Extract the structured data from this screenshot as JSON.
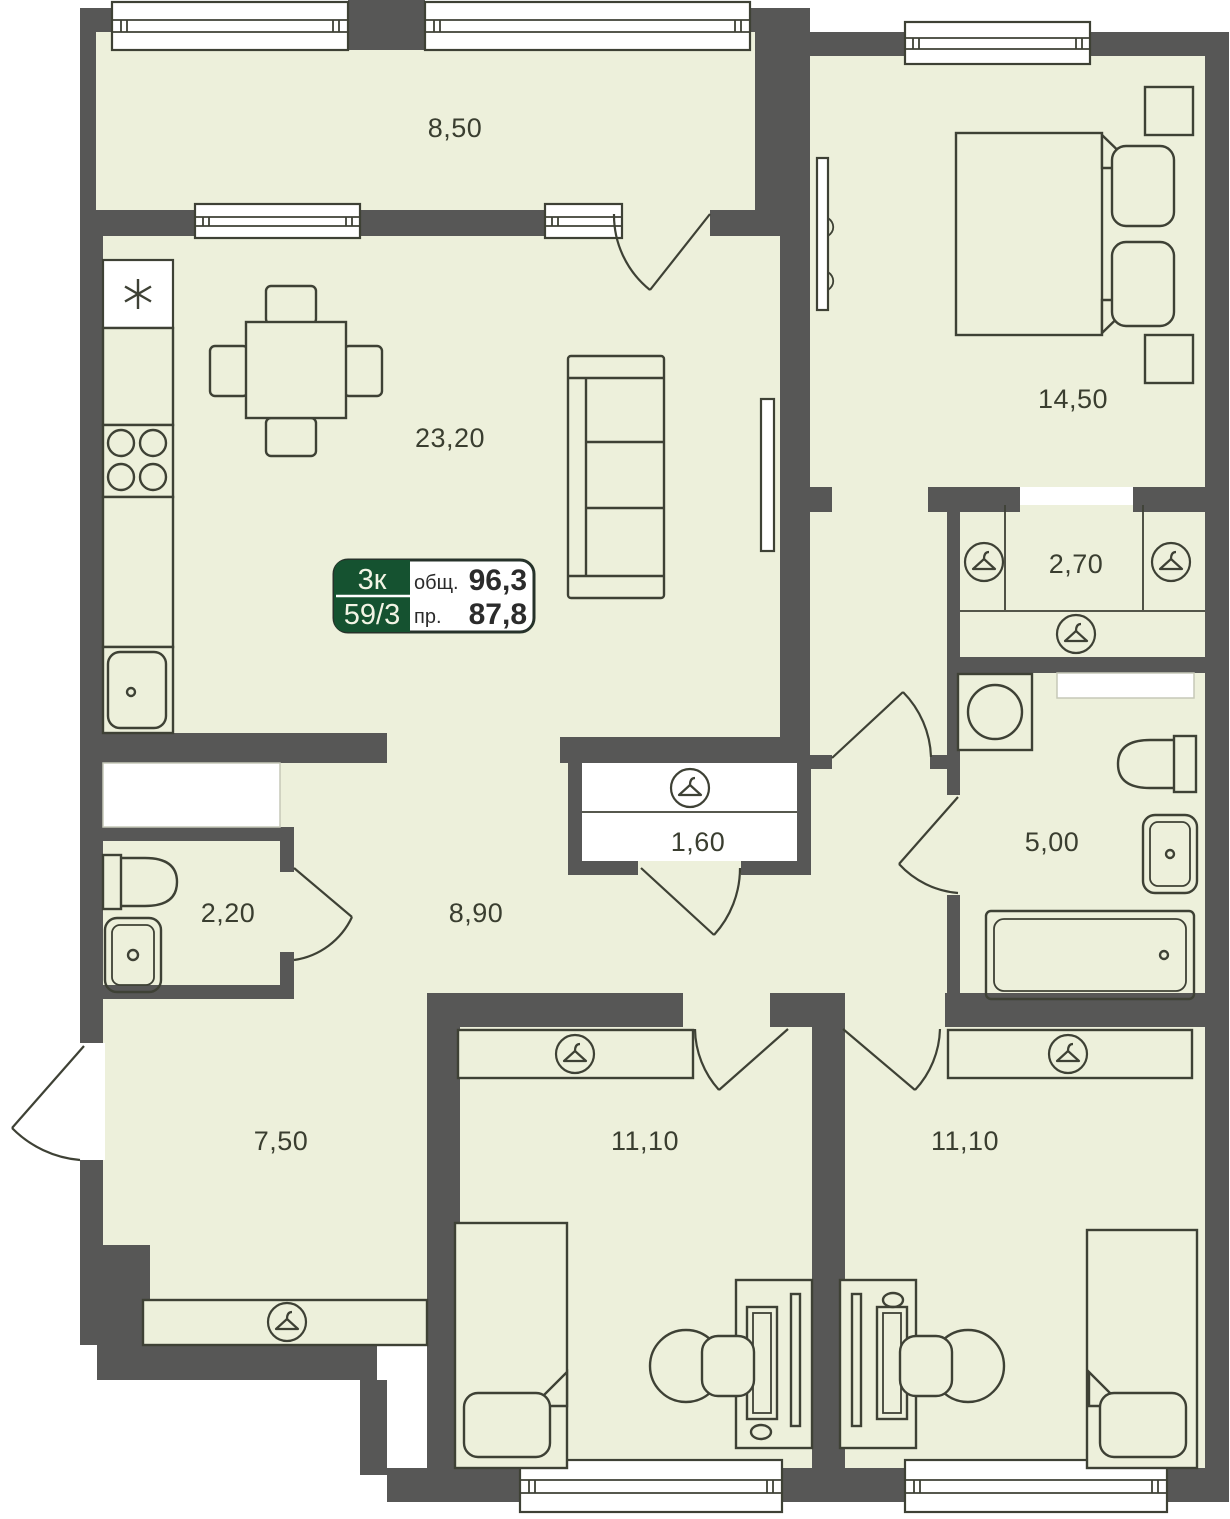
{
  "plan": {
    "unit_badge": {
      "rooms_label": "3к",
      "unit_number": "59/3",
      "total_label": "общ.",
      "total_value": "96,3",
      "living_label": "пр.",
      "living_value": "87,8"
    },
    "rooms": [
      {
        "name": "balcony",
        "area": "8,50"
      },
      {
        "name": "kitchen-living-room",
        "area": "23,20"
      },
      {
        "name": "master-bedroom",
        "area": "14,50"
      },
      {
        "name": "walk-in-wardrobe",
        "area": "2,70"
      },
      {
        "name": "hall-closet",
        "area": "1,60"
      },
      {
        "name": "bathroom",
        "area": "5,00"
      },
      {
        "name": "wc",
        "area": "2,20"
      },
      {
        "name": "hallway",
        "area": "8,90"
      },
      {
        "name": "entry-hall",
        "area": "7,50"
      },
      {
        "name": "bedroom-1",
        "area": "11,10"
      },
      {
        "name": "bedroom-2",
        "area": "11,10"
      }
    ],
    "icons": [
      "hanger-icon",
      "stove-icon",
      "kitchen-sink-icon",
      "washing-machine-icon",
      "toilet-icon",
      "sink-icon",
      "bathtub-icon",
      "sofa-icon",
      "tv-icon",
      "bed-icon",
      "desk-icon",
      "chair-icon",
      "star-icon"
    ],
    "colors": {
      "floor": "#edf0db",
      "wall": "#575756",
      "line": "#3e4135",
      "accent_green": "#155230",
      "background": "#ffffff",
      "label_text": "#3a3e30"
    }
  }
}
